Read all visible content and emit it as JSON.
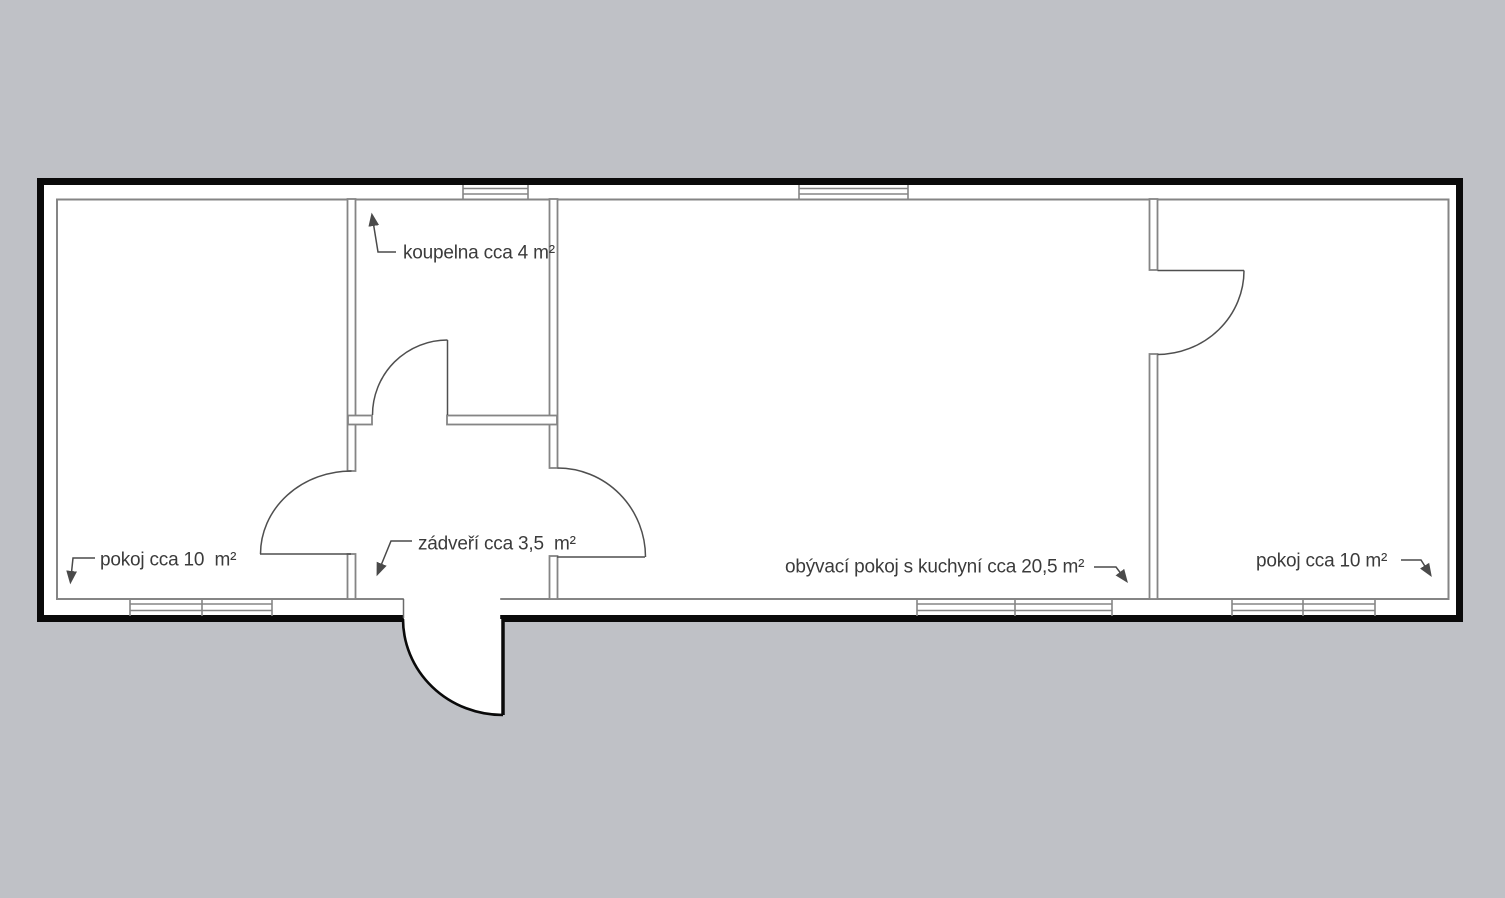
{
  "drawing": {
    "type": "apartment-floor-plan",
    "colors": {
      "background": "#bfc1c6",
      "floor_fill": "#ffffff",
      "exterior_wall": "#0a0a0a",
      "interior_line": "#858585",
      "door_line": "#4f4f4f",
      "leader_line": "#4a4a4a",
      "label_text": "#3b3b3b"
    },
    "rooms": [
      {
        "id": "room-left",
        "label": "pokoj cca 10  m²"
      },
      {
        "id": "bathroom",
        "label": "koupelna cca 4 m²"
      },
      {
        "id": "entrance-hall",
        "label": "zádveří cca 3,5  m²"
      },
      {
        "id": "living-room-kitchen",
        "label": "obývací pokoj s kuchyní cca 20,5 m²"
      },
      {
        "id": "room-right",
        "label": "pokoj cca 10 m²"
      }
    ]
  }
}
